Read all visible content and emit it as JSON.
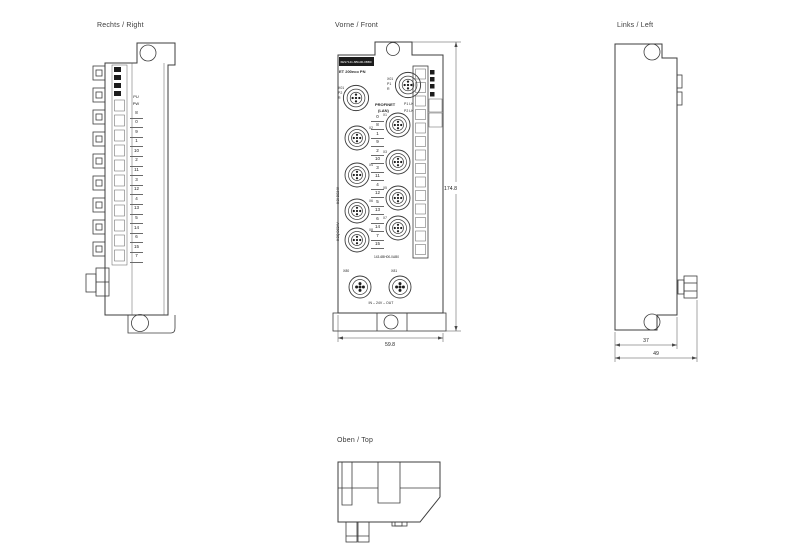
{
  "page": {
    "title_right": "Rechts / Right",
    "title_front": "Vorne / Front",
    "title_left": "Links / Left",
    "title_top": "Oben / Top",
    "front_panel": {
      "order_no": "6ES7141-6BG00-0BB0",
      "product": "ET 200eco PN",
      "port1_lines": [
        "X01",
        "P1",
        "R"
      ],
      "port2_lines": [
        "X01",
        "P2",
        "R"
      ],
      "bus_line1": "PROFINET",
      "bus_line2": "(LAN)",
      "led_line1": "P1 LK",
      "led_line2": "P2 LK",
      "side_text1": "8 DI DC24V",
      "side_text2": "8 DQ DC24V",
      "io_right_ids": [
        "X1",
        "X3",
        "X5",
        "X7"
      ],
      "io_left_ids": [
        "X2",
        "X4",
        "X6",
        "X8"
      ],
      "channels": [
        "0",
        "8",
        "1",
        "9",
        "2",
        "10",
        "3",
        "11",
        "4",
        "12",
        "5",
        "13",
        "6",
        "14",
        "7",
        "15"
      ],
      "article_no": "143-6BH00-0AB0",
      "power_left": "X80",
      "power_right": "X81",
      "power_line": "IN – 24V – OUT"
    },
    "right_panel": {
      "pin_headers": [
        "PU",
        "PW"
      ],
      "channels": [
        "8",
        "0",
        "9",
        "1",
        "10",
        "2",
        "11",
        "3",
        "12",
        "4",
        "13",
        "5",
        "14",
        "6",
        "15",
        "7"
      ]
    },
    "dims": {
      "height": "174.8",
      "width": "59.8",
      "depth_inner": "37",
      "depth_total": "49"
    },
    "colors": {
      "line": "#3c3c3c",
      "black_fill": "#1c1c1c"
    }
  }
}
